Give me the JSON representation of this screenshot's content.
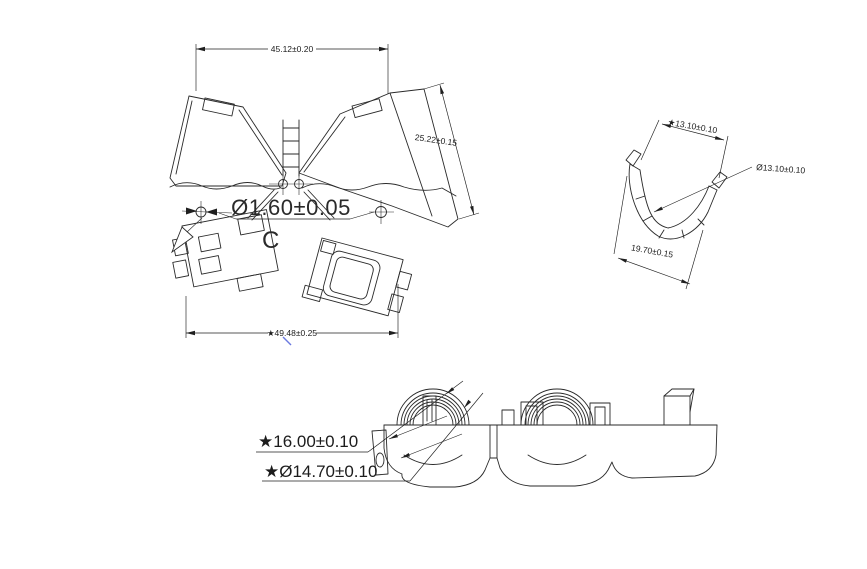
{
  "drawing": {
    "background_color": "#ffffff",
    "line_color": "#2a2a2a",
    "accent_blue": "#6b79e0",
    "open_view": {
      "name": "open clamp front view",
      "dim_width_top": "45.12±0.20",
      "dim_side": "25.22±0.15",
      "dim_pin_diameter": "Ø1.60±0.05",
      "section_label": "C",
      "dim_width_bottom": "★49.48±0.25"
    },
    "section_view": {
      "name": "C profile section view",
      "dim_opening": "★13.10±0.10",
      "dim_inner_diameter": "Ø13.10±0.10",
      "dim_outer_width": "19.70±0.15"
    },
    "side_view": {
      "name": "closed clamp side view",
      "dim_height": "★16.00±0.10",
      "dim_core_diameter": "★Ø14.70±0.10"
    }
  }
}
